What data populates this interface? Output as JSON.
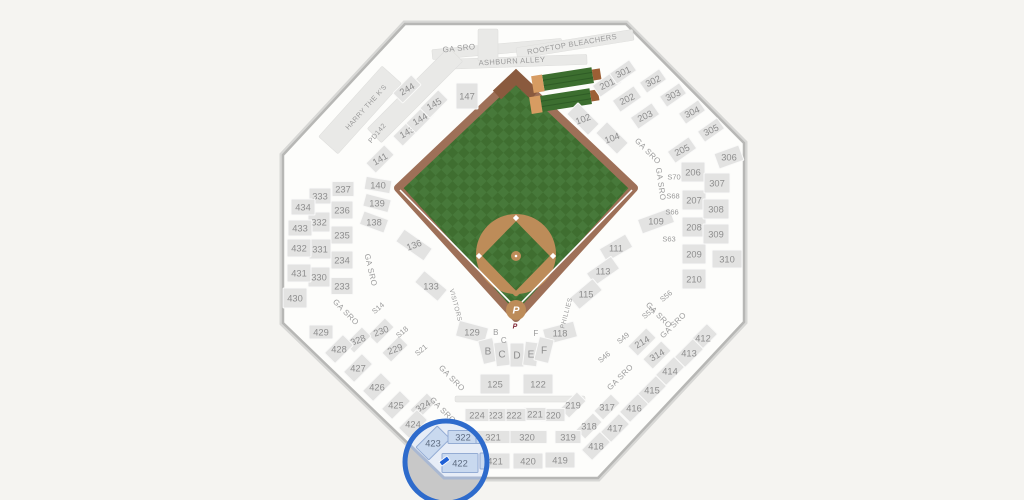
{
  "canvas": {
    "w": 1024,
    "h": 500,
    "bg": "#f5f4f1"
  },
  "selected_section": "422",
  "stadium": {
    "outline": "405,24 626,24 744,143 744,322 598,478 444,478 283,323 283,155",
    "interior": "#fdfdfb",
    "border": "#b7b7b5",
    "border_outer": "#d7d7d5",
    "section_fill": "#e3e3e2",
    "section_stroke": "#fafaf9",
    "label_color": "#8d8d8d"
  },
  "field": {
    "outline": "516,76 398,188 516,318 634,188",
    "wall": "#9e7058",
    "eye": "#8a5a3e",
    "grass1": "#47793a",
    "grass2": "#3f6e30",
    "dirt": "#bd8c59",
    "line": "#ffffff",
    "dirt_circle": {
      "cx": 516,
      "cy": 254,
      "r": 40
    },
    "diamond": "516,294 553,256 516,218 479,256",
    "bases": [
      [
        553,
        256
      ],
      [
        516,
        218
      ],
      [
        479,
        256
      ]
    ],
    "mound": {
      "cx": 516,
      "cy": 256,
      "r": 5
    },
    "home": {
      "cx": 516,
      "cy": 310,
      "r": 10
    },
    "home_logo": "P",
    "home_logo_color": "#ffffff",
    "mini_logo": "P",
    "mini_logo_color": "#7d2333",
    "foul_left": "513,305 400,190",
    "foul_right": "519,305 632,190"
  },
  "bleachers": [
    [
      568,
      79,
      -9
    ],
    [
      566,
      100,
      -9
    ]
  ],
  "bleacher_colors": {
    "deck": "#3c6e2f",
    "stripe": "#2f5c26",
    "tan": "#d79c62",
    "brown": "#9c5f35"
  },
  "strips": [
    [
      497,
      49,
      130,
      10,
      -5
    ],
    [
      575,
      44,
      118,
      11,
      -9
    ],
    [
      512,
      62,
      150,
      10,
      -2
    ],
    [
      360,
      110,
      95,
      26,
      -48
    ],
    [
      415,
      95,
      115,
      20,
      -45
    ],
    [
      488,
      45,
      20,
      32,
      0
    ],
    [
      520,
      399,
      130,
      6,
      0
    ]
  ],
  "sections": [
    [
      "102",
      583,
      119,
      45,
      30,
      16,
      -20
    ],
    [
      "104",
      612,
      138,
      45,
      30,
      16,
      -20
    ],
    [
      "109",
      656,
      221,
      -20,
      34,
      15,
      0
    ],
    [
      "111",
      616,
      248,
      -30,
      30,
      15,
      0
    ],
    [
      "113",
      603,
      271,
      -35,
      30,
      15,
      0
    ],
    [
      "115",
      586,
      294,
      -40,
      30,
      15,
      0
    ],
    [
      "118",
      560,
      333,
      -15,
      32,
      16,
      0
    ],
    [
      "122",
      538,
      384,
      0,
      30,
      20,
      0
    ],
    [
      "125",
      495,
      384,
      0,
      30,
      20,
      0
    ],
    [
      "129",
      472,
      332,
      15,
      30,
      16,
      0
    ],
    [
      "133",
      431,
      286,
      40,
      30,
      15,
      0
    ],
    [
      "136",
      414,
      245,
      35,
      34,
      15,
      -20
    ],
    [
      "138",
      374,
      222,
      20,
      26,
      14,
      0
    ],
    [
      "139",
      377,
      203,
      15,
      26,
      13,
      0
    ],
    [
      "140",
      378,
      185,
      10,
      26,
      13,
      0
    ],
    [
      "141",
      380,
      159,
      -45,
      26,
      14,
      -30
    ],
    [
      "143",
      407,
      132,
      -45,
      26,
      14,
      -30
    ],
    [
      "144",
      420,
      119,
      -45,
      26,
      14,
      -30
    ],
    [
      "145",
      434,
      104,
      -45,
      26,
      14,
      -30
    ],
    [
      "147",
      467,
      96,
      0,
      22,
      26,
      0
    ],
    [
      "201",
      607,
      84,
      -35,
      26,
      14,
      -25
    ],
    [
      "202",
      627,
      99,
      -35,
      26,
      14,
      -25
    ],
    [
      "203",
      645,
      116,
      -35,
      26,
      14,
      -25
    ],
    [
      "205",
      682,
      150,
      -35,
      26,
      14,
      -25
    ],
    [
      "206",
      693,
      172,
      0,
      24,
      20,
      0
    ],
    [
      "207",
      694,
      200,
      0,
      24,
      20,
      0
    ],
    [
      "208",
      694,
      227,
      0,
      24,
      20,
      0
    ],
    [
      "209",
      694,
      254,
      0,
      24,
      20,
      0
    ],
    [
      "210",
      694,
      279,
      0,
      24,
      20,
      0
    ],
    [
      "214",
      642,
      342,
      -45,
      26,
      14,
      -30
    ],
    [
      "219",
      573,
      405,
      -45,
      24,
      13,
      0
    ],
    [
      "220",
      553,
      415,
      0,
      24,
      13,
      0
    ],
    [
      "221",
      535,
      414,
      0,
      22,
      13,
      0
    ],
    [
      "222",
      514,
      415,
      0,
      24,
      13,
      0
    ],
    [
      "223",
      495,
      415,
      0,
      22,
      13,
      0
    ],
    [
      "224",
      477,
      415,
      0,
      24,
      13,
      0
    ],
    [
      "229",
      395,
      349,
      -45,
      24,
      13,
      -20
    ],
    [
      "230",
      381,
      331,
      -45,
      24,
      13,
      -20
    ],
    [
      "233",
      342,
      286,
      0,
      22,
      17,
      0
    ],
    [
      "234",
      342,
      260,
      0,
      22,
      18,
      0
    ],
    [
      "235",
      342,
      235,
      0,
      22,
      18,
      0
    ],
    [
      "236",
      342,
      210,
      0,
      22,
      18,
      0
    ],
    [
      "237",
      343,
      189,
      0,
      22,
      15,
      0
    ],
    [
      "244",
      407,
      89,
      -45,
      26,
      14,
      -30
    ],
    [
      "301",
      623,
      72,
      -35,
      24,
      13,
      -25
    ],
    [
      "302",
      653,
      81,
      -35,
      24,
      13,
      -25
    ],
    [
      "303",
      673,
      95,
      -35,
      24,
      13,
      -25
    ],
    [
      "304",
      692,
      112,
      -35,
      24,
      13,
      -25
    ],
    [
      "305",
      711,
      130,
      -35,
      24,
      13,
      -25
    ],
    [
      "306",
      729,
      157,
      -20,
      26,
      16,
      0
    ],
    [
      "307",
      717,
      183,
      0,
      26,
      20,
      0
    ],
    [
      "308",
      716,
      209,
      0,
      26,
      20,
      0
    ],
    [
      "309",
      716,
      234,
      0,
      26,
      20,
      0
    ],
    [
      "310",
      727,
      259,
      0,
      30,
      18,
      0
    ],
    [
      "314",
      657,
      355,
      -45,
      26,
      14,
      -30
    ],
    [
      "317",
      607,
      407,
      -45,
      24,
      13,
      0
    ],
    [
      "318",
      589,
      426,
      -45,
      24,
      13,
      0
    ],
    [
      "319",
      568,
      437,
      0,
      26,
      13,
      0
    ],
    [
      "320",
      527,
      437,
      0,
      40,
      13,
      0
    ],
    [
      "321",
      493,
      437,
      0,
      34,
      13,
      0
    ],
    [
      "324",
      423,
      406,
      -45,
      24,
      13,
      -30
    ],
    [
      "328",
      358,
      340,
      -45,
      24,
      13,
      -20
    ],
    [
      "330",
      319,
      277,
      0,
      22,
      20,
      0
    ],
    [
      "331",
      320,
      249,
      0,
      22,
      20,
      0
    ],
    [
      "332",
      319,
      222,
      0,
      22,
      20,
      0
    ],
    [
      "333",
      320,
      196,
      0,
      22,
      16,
      0
    ],
    [
      "412",
      703,
      338,
      -45,
      26,
      15,
      0
    ],
    [
      "413",
      689,
      353,
      -45,
      26,
      15,
      0
    ],
    [
      "414",
      670,
      371,
      -45,
      26,
      15,
      0
    ],
    [
      "415",
      652,
      390,
      -45,
      26,
      15,
      0
    ],
    [
      "416",
      634,
      408,
      -45,
      26,
      15,
      0
    ],
    [
      "417",
      615,
      428,
      -45,
      26,
      15,
      0
    ],
    [
      "418",
      596,
      446,
      -45,
      26,
      15,
      0
    ],
    [
      "419",
      560,
      460,
      0,
      30,
      16,
      0
    ],
    [
      "420",
      528,
      461,
      0,
      30,
      16,
      0
    ],
    [
      "421",
      495,
      461,
      0,
      30,
      16,
      0
    ],
    [
      "424",
      413,
      424,
      -45,
      26,
      15,
      0
    ],
    [
      "425",
      396,
      405,
      -45,
      26,
      15,
      0
    ],
    [
      "426",
      377,
      387,
      -45,
      26,
      15,
      0
    ],
    [
      "427",
      358,
      368,
      -45,
      26,
      15,
      0
    ],
    [
      "428",
      339,
      349,
      -45,
      26,
      15,
      0
    ],
    [
      "429",
      321,
      332,
      0,
      24,
      14,
      0
    ],
    [
      "430",
      295,
      298,
      0,
      24,
      20,
      0
    ],
    [
      "431",
      299,
      273,
      0,
      24,
      18,
      0
    ],
    [
      "432",
      299,
      248,
      0,
      24,
      18,
      0
    ],
    [
      "433",
      300,
      228,
      0,
      24,
      16,
      0
    ],
    [
      "434",
      303,
      207,
      0,
      24,
      16,
      0
    ],
    [
      "B",
      488,
      351,
      -14,
      15,
      24,
      0
    ],
    [
      "C",
      502,
      354,
      -7,
      14,
      24,
      0
    ],
    [
      "D",
      517,
      355,
      0,
      14,
      24,
      0
    ],
    [
      "E",
      531,
      354,
      7,
      14,
      24,
      0
    ],
    [
      "F",
      544,
      350,
      14,
      15,
      24,
      0
    ]
  ],
  "suites": [
    [
      "S14",
      378,
      308,
      -40
    ],
    [
      "S18",
      402,
      332,
      -40
    ],
    [
      "S21",
      421,
      350,
      -40
    ],
    [
      "S46",
      604,
      357,
      -40
    ],
    [
      "S49",
      623,
      338,
      -40
    ],
    [
      "S53",
      648,
      313,
      -40
    ],
    [
      "S56",
      666,
      296,
      -40
    ],
    [
      "S63",
      669,
      239,
      0
    ],
    [
      "S66",
      672,
      212,
      0
    ],
    [
      "S68",
      673,
      196,
      0
    ],
    [
      "S70",
      674,
      177,
      0
    ]
  ],
  "texts": [
    [
      "GA SRO",
      459,
      48,
      -6,
      8
    ],
    [
      "GA SRO",
      648,
      151,
      45,
      8
    ],
    [
      "GA SRO",
      661,
      184,
      82,
      8
    ],
    [
      "GA SRO",
      659,
      315,
      45,
      8
    ],
    [
      "GA SRO",
      673,
      325,
      -45,
      8
    ],
    [
      "GA SRO",
      620,
      377,
      -45,
      8
    ],
    [
      "GA SRO",
      371,
      270,
      77,
      8
    ],
    [
      "GA SRO",
      346,
      312,
      45,
      8
    ],
    [
      "GA SRO",
      452,
      378,
      45,
      8
    ],
    [
      "GA SRO",
      443,
      410,
      45,
      8
    ],
    [
      "ROOFTOP BLEACHERS",
      572,
      44,
      -10,
      7.5
    ],
    [
      "ASHBURN ALLEY",
      512,
      61,
      -3,
      7.5
    ],
    [
      "HARRY THE K'S",
      366,
      107,
      -48,
      7
    ],
    [
      "PD142",
      377,
      133,
      -50,
      7
    ],
    [
      "VISITORS",
      456,
      305,
      75,
      6.5
    ],
    [
      "PHILLIES",
      566,
      313,
      -75,
      6.5
    ],
    [
      "B",
      496,
      332,
      0,
      8
    ],
    [
      "C",
      504,
      340,
      0,
      8
    ],
    [
      "F",
      536,
      333,
      0,
      8
    ]
  ],
  "overlay": {
    "cx": 446,
    "cy": 462,
    "r": 41,
    "ring": "#2e6bcc",
    "outside": "#c8c8c8",
    "inside": "#e7edf7",
    "edge_stroke": "#a9b8d2",
    "tint_fill": "#c9d9ef",
    "tint_stroke": "#94acd4",
    "label_color": "#5d6b80",
    "sections": [
      [
        "423",
        433,
        443,
        -45,
        30,
        18
      ],
      [
        "422",
        460,
        463,
        0,
        36,
        19
      ],
      [
        "322",
        463,
        437,
        0,
        30,
        13
      ],
      [
        "321",
        493,
        437,
        0,
        34,
        13
      ],
      [
        "421",
        495,
        461,
        0,
        30,
        16
      ],
      [
        "424",
        413,
        424,
        -45,
        26,
        15
      ]
    ],
    "marker": {
      "x": 444,
      "y": 459,
      "color": "#2061d6"
    }
  }
}
